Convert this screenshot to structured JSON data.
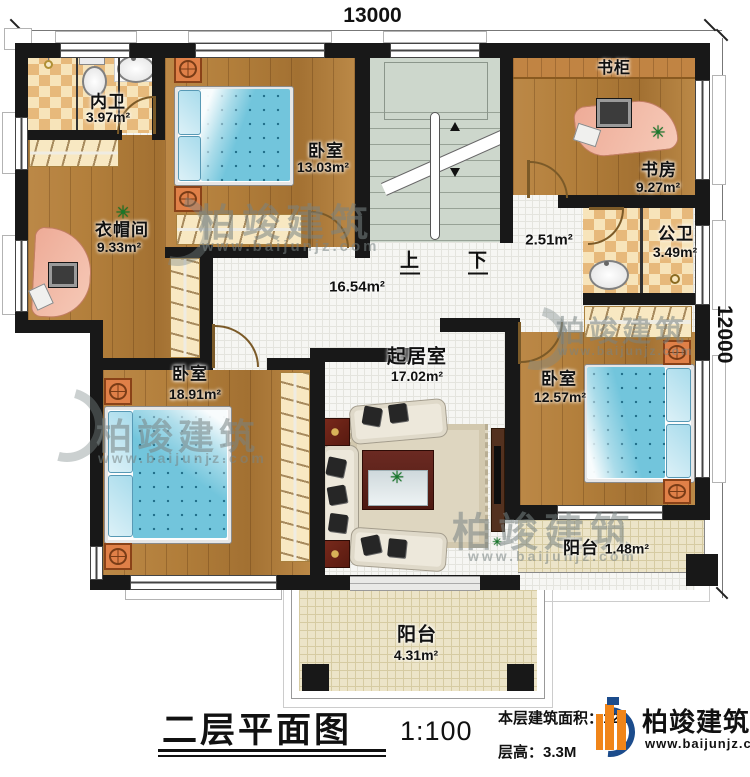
{
  "dims": {
    "top": "13000",
    "right": "12000"
  },
  "rooms": {
    "neiwei": {
      "name": "内卫",
      "area": "3.97m²"
    },
    "bedroom_top": {
      "name": "卧室",
      "area": "13.03m²"
    },
    "bookcase": {
      "label": "书柜"
    },
    "study": {
      "name": "书房",
      "area": "9.27m²"
    },
    "corridor": {
      "area": "2.51m²"
    },
    "gongwei": {
      "name": "公卫",
      "area": "3.49m²"
    },
    "cloakroom": {
      "name": "衣帽间",
      "area": "9.33m²"
    },
    "hall": {
      "area": "16.54m²"
    },
    "living": {
      "name": "起居室",
      "area": "17.02m²"
    },
    "bedroom_left": {
      "name": "卧室",
      "area": "18.91m²"
    },
    "bedroom_right": {
      "name": "卧室",
      "area": "12.57m²"
    },
    "balcony_small": {
      "name": "阳台",
      "area": "1.48m²"
    },
    "balcony_large": {
      "name": "阳台",
      "area": "4.31m²"
    }
  },
  "stairs": {
    "up_label": "上",
    "down_label": "下"
  },
  "title_block": {
    "title": "二层平面图",
    "scale": "1:100",
    "area_text": "本层建筑面积：124.",
    "height_text": "层高：3.3M"
  },
  "brand": {
    "name": "柏竣建筑",
    "website": "www.baijunjz.com"
  },
  "colors": {
    "wall": "#181818",
    "wood": "#b5813d",
    "tile": "#f6f6f3",
    "balcony_tile": "#ece4c8",
    "checker_dark": "#e7b97b",
    "checker_light": "#f7e4ba",
    "stair": "#cdd7cc",
    "mattress": "#72c5dc",
    "logo_blue": "#1c4c8c",
    "logo_orange": "#f08519"
  }
}
